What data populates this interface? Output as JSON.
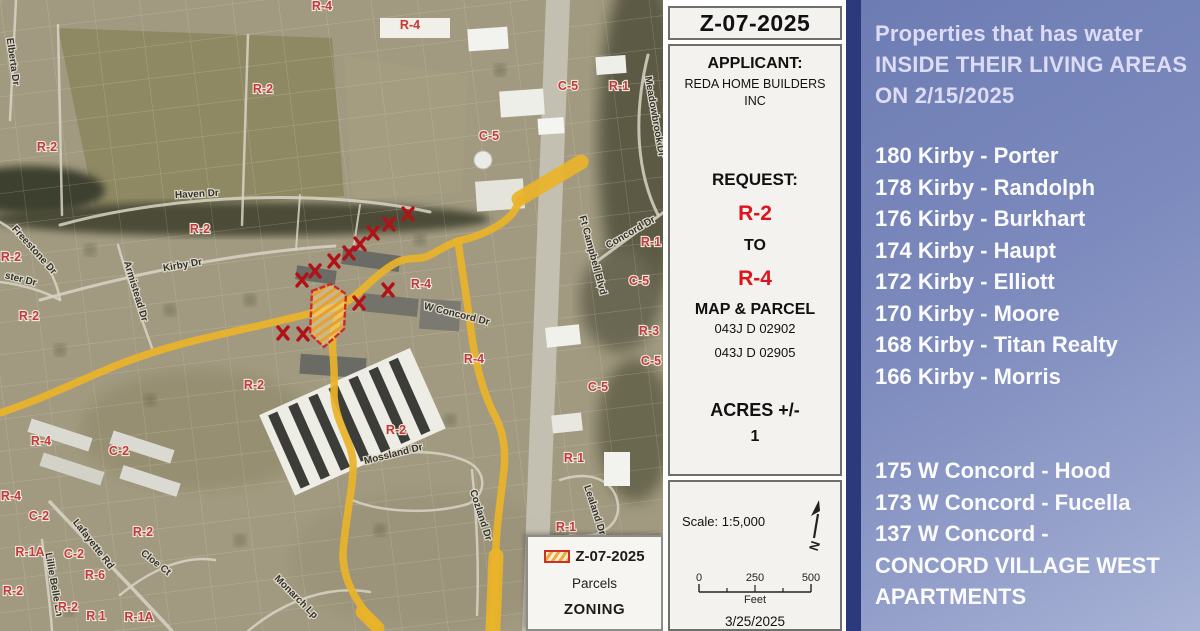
{
  "map": {
    "legend": {
      "title": "Z-07-2025",
      "parcels_label": "Parcels",
      "zoning_label": "ZONING"
    },
    "zone_labels": [
      {
        "t": "R-4",
        "x": 322,
        "y": 10
      },
      {
        "t": "R-4",
        "x": 410,
        "y": 29
      },
      {
        "t": "R-2",
        "x": 263,
        "y": 93
      },
      {
        "t": "R-2",
        "x": 47,
        "y": 151
      },
      {
        "t": "C-5",
        "x": 568,
        "y": 90
      },
      {
        "t": "R-1",
        "x": 619,
        "y": 90
      },
      {
        "t": "C-5",
        "x": 489,
        "y": 140
      },
      {
        "t": "R-2",
        "x": 200,
        "y": 233
      },
      {
        "t": "R-1",
        "x": 651,
        "y": 246
      },
      {
        "t": "R-2",
        "x": 11,
        "y": 261
      },
      {
        "t": "C-5",
        "x": 639,
        "y": 285
      },
      {
        "t": "R-4",
        "x": 421,
        "y": 288
      },
      {
        "t": "R-2",
        "x": 29,
        "y": 320
      },
      {
        "t": "R-2",
        "x": 254,
        "y": 389
      },
      {
        "t": "C-5",
        "x": 598,
        "y": 391
      },
      {
        "t": "R-3",
        "x": 649,
        "y": 335
      },
      {
        "t": "C-5",
        "x": 651,
        "y": 365
      },
      {
        "t": "R-2",
        "x": 396,
        "y": 434
      },
      {
        "t": "R-4",
        "x": 474,
        "y": 363
      },
      {
        "t": "R-1",
        "x": 574,
        "y": 462
      },
      {
        "t": "R-1",
        "x": 566,
        "y": 531
      },
      {
        "t": "R-4",
        "x": 41,
        "y": 445
      },
      {
        "t": "R-4",
        "x": 11,
        "y": 500
      },
      {
        "t": "C-2",
        "x": 119,
        "y": 455
      },
      {
        "t": "C-2",
        "x": 39,
        "y": 520
      },
      {
        "t": "C-2",
        "x": 74,
        "y": 558
      },
      {
        "t": "R-2",
        "x": 143,
        "y": 536
      },
      {
        "t": "R-1A",
        "x": 30,
        "y": 556
      },
      {
        "t": "R-6",
        "x": 95,
        "y": 579
      },
      {
        "t": "R-2",
        "x": 13,
        "y": 595
      },
      {
        "t": "R-2",
        "x": 68,
        "y": 611
      },
      {
        "t": "R 1",
        "x": 96,
        "y": 620
      },
      {
        "t": "R-1A",
        "x": 139,
        "y": 621
      }
    ],
    "street_labels": [
      {
        "t": "Haven Dr",
        "x": 197,
        "y": 197,
        "a": -3
      },
      {
        "t": "Kirby Dr",
        "x": 183,
        "y": 268,
        "a": -10
      },
      {
        "t": "Armistead Dr",
        "x": 133,
        "y": 292,
        "a": 73
      },
      {
        "t": "Elberta Dr",
        "x": 10,
        "y": 62,
        "a": 82
      },
      {
        "t": "Freestone Dr",
        "x": 32,
        "y": 252,
        "a": 48
      },
      {
        "t": "ster Dr",
        "x": 20,
        "y": 282,
        "a": 14
      },
      {
        "t": "W Concord Dr",
        "x": 456,
        "y": 317,
        "a": 14
      },
      {
        "t": "Concord Dr",
        "x": 632,
        "y": 235,
        "a": -30
      },
      {
        "t": "Ft Campbell Blvd",
        "x": 590,
        "y": 256,
        "a": 75
      },
      {
        "t": "Meadowbrook Dr",
        "x": 652,
        "y": 117,
        "a": 80
      },
      {
        "t": "Mossland Dr",
        "x": 394,
        "y": 457,
        "a": -14
      },
      {
        "t": "Lealand Dr",
        "x": 592,
        "y": 511,
        "a": 72
      },
      {
        "t": "Lafayette Rd",
        "x": 91,
        "y": 546,
        "a": 52
      },
      {
        "t": "Lillie Belle Ln",
        "x": 51,
        "y": 585,
        "a": 80
      },
      {
        "t": "Cloe Ct",
        "x": 154,
        "y": 565,
        "a": 38
      },
      {
        "t": "Monarch Lp",
        "x": 294,
        "y": 599,
        "a": 45
      },
      {
        "t": "Cozland Dr",
        "x": 478,
        "y": 516,
        "a": 72
      }
    ],
    "x_marks": [
      {
        "x": 408,
        "y": 214
      },
      {
        "x": 389,
        "y": 224
      },
      {
        "x": 373,
        "y": 233
      },
      {
        "x": 360,
        "y": 244
      },
      {
        "x": 349,
        "y": 253
      },
      {
        "x": 334,
        "y": 261
      },
      {
        "x": 315,
        "y": 271
      },
      {
        "x": 302,
        "y": 280
      },
      {
        "x": 388,
        "y": 290
      },
      {
        "x": 359,
        "y": 303
      },
      {
        "x": 303,
        "y": 334
      },
      {
        "x": 283,
        "y": 333
      }
    ],
    "parcel_points": "312,291 331,284 346,294 344,329 324,347 310,334",
    "roads_yellow": [
      {
        "d": "M 0,413 C 45,398 85,378 115,366 C 160,348 200,339 240,330 C 275,322 305,315 332,308 C 348,303 356,295 364,288 C 377,276 388,266 400,261 C 410,257 420,260 428,256 C 440,250 450,243 462,240 C 480,236 497,228 508,218 C 515,212 518,204 521,198",
        "w": 7.5
      },
      {
        "d": "M 519,199 L 581,162",
        "w": 15
      },
      {
        "d": "M 344,306 C 335,320 331,338 333,354 C 335,374 334,386 334,396 C 336,424 352,442 353,462 C 354,486 345,520 343,553 C 342,582 360,606 376,626",
        "w": 7.5
      },
      {
        "d": "M 362,612 L 378,628",
        "w": 13
      },
      {
        "d": "M 458,241 C 462,270 467,300 471,330 C 475,362 482,392 496,418 C 505,436 506,458 503,478 C 500,505 497,522 496,546 C 495,576 494,602 493,628",
        "w": 7.5
      },
      {
        "d": "M 496,556 L 493,630",
        "w": 15
      }
    ],
    "roads_gray": [
      {
        "d": "M 558,0 L 534,631",
        "w": 24,
        "c": "#c9c5ba"
      },
      {
        "d": "M 60,225 C 180,192 330,190 430,212",
        "w": 3
      },
      {
        "d": "M 40,300 C 140,272 240,252 335,246",
        "w": 3
      },
      {
        "d": "M 118,245 C 128,280 140,315 152,348",
        "w": 2.5
      },
      {
        "d": "M 248,35 L 242,225",
        "w": 2.5
      },
      {
        "d": "M 58,25 L 62,215",
        "w": 2.5
      },
      {
        "d": "M 16,0 C 14,40 12,80 10,120",
        "w": 2.5
      },
      {
        "d": "M 0,222 C 30,240 55,268 60,300",
        "w": 2.5
      },
      {
        "d": "M 0,282 C 25,285 45,292 60,300",
        "w": 2.5
      },
      {
        "d": "M 648,55 C 632,120 638,175 658,215",
        "w": 3
      },
      {
        "d": "M 596,262 L 664,212",
        "w": 3
      },
      {
        "d": "M 332,478 C 372,452 430,444 468,462 C 488,472 486,496 468,504 C 430,515 380,512 352,500",
        "w": 2.5
      },
      {
        "d": "M 50,502 C 90,545 135,590 172,631",
        "w": 3.5
      },
      {
        "d": "M 42,540 C 46,572 50,602 52,631",
        "w": 2.5
      },
      {
        "d": "M 120,595 C 150,570 185,555 215,560",
        "w": 2.5
      },
      {
        "d": "M 248,631 C 285,600 330,585 370,592",
        "w": 2.5
      },
      {
        "d": "M 472,470 C 477,520 479,570 477,615",
        "w": 2.5
      },
      {
        "d": "M 560,480 C 590,470 615,480 618,505 C 620,528 595,540 570,535",
        "w": 2.5
      },
      {
        "d": "M 300,195 L 296,250",
        "w": 2
      },
      {
        "d": "M 360,205 L 352,258",
        "w": 2
      }
    ]
  },
  "info_panel": {
    "case_number": "Z-07-2025",
    "applicant_label": "APPLICANT:",
    "applicant_name": "REDA HOME BUILDERS INC",
    "request_label": "REQUEST:",
    "from_zone": "R-2",
    "to_word": "TO",
    "to_zone": "R-4",
    "map_parcel_label": "MAP & PARCEL",
    "parcel_1": "043J D 02902",
    "parcel_2": "043J D 02905",
    "acres_label": "ACRES +/-",
    "acres_value": "1",
    "scale_label": "Scale: 1:5,000",
    "north_letter": "N",
    "scale_ticks": [
      "0",
      "250",
      "500"
    ],
    "scale_unit": "Feet",
    "date": "3/25/2025"
  },
  "water_panel": {
    "title_lines": [
      "Properties that has water",
      "INSIDE THEIR LIVING AREAS",
      "ON 2/15/2025"
    ],
    "kirby_list": [
      "180 Kirby - Porter",
      "178 Kirby - Randolph",
      "176 Kirby - Burkhart",
      "174 Kirby - Haupt",
      "172 Kirby - Elliott",
      "170 Kirby - Moore",
      "168 Kirby - Titan Realty",
      "166 Kirby - Morris"
    ],
    "concord_list": [
      "175 W Concord - Hood",
      "173 W Concord - Fucella",
      "137 W Concord -\nCONCORD VILLAGE WEST\nAPARTMENTS"
    ]
  },
  "colors": {
    "yellow_road": "#e9b32a",
    "x_mark_red": "#b01218",
    "zone_label_red": "#c23a3e",
    "parcel_border_red": "#cf2b20",
    "panel_blue": "#7c8abd",
    "navy_strip": "#2c3a7c",
    "request_red": "#e0121c"
  }
}
